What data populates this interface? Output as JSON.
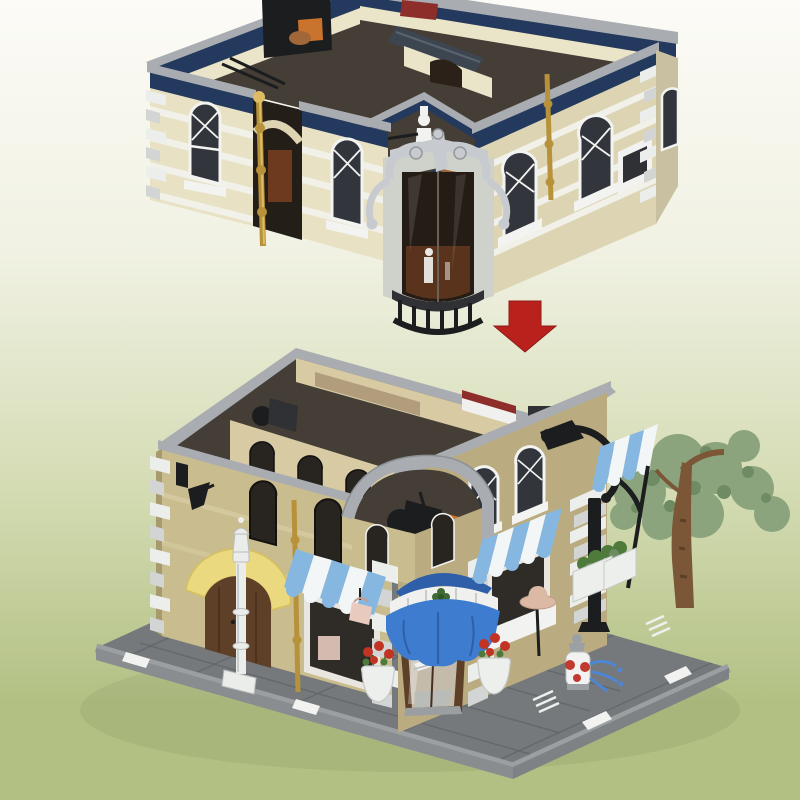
{
  "meta": {
    "image_type": "product-render",
    "subject": "Brick-built modular corner hat shop set shown as exploded view: open-top upper floor module above, red assembly arrow, completed two-story corner shop on gray street baseplate below",
    "upper_module_label": "upper floor module with navy trim, arched windows, silver scroll corner bay and black balcony",
    "arrow_label": "red downward assembly arrow",
    "lower_building_label": "assembled corner shop with blue dome awning entrance, striped awnings, street tree, lamp post and fire hydrant"
  },
  "colors": {
    "bg_top": "#fcfbf7",
    "bg_mid": "#f0f1e2",
    "bg_low": "#d3dbb2",
    "bg_bottom": "#b2c083",
    "arrow": "#b9211d",
    "coping": "#a9adb2",
    "coping_dark": "#8b9095",
    "navy": "#23395d",
    "cream": "#e8e1c3",
    "cream_dark": "#dcd4b2",
    "cream_deep": "#c8c0a0",
    "white_brick": "#f1f1e9",
    "quoin_w": "#eceeeb",
    "quoin_g": "#d2d5d3",
    "stone": "#cfd1cb",
    "stone_dark": "#a9aca5",
    "silver": "#c7cbcf",
    "silver_dark": "#94989d",
    "win_frame": "#f3f4f1",
    "win_dark": "#32363c",
    "win_dark2": "#282420",
    "glass_brown": "#251c15",
    "glass_glow": "#64371f",
    "gold": "#b7923b",
    "gold_hi": "#ddbc63",
    "black": "#1c1d1e",
    "black_soft": "#303134",
    "int_floor": "#443e36",
    "int_wall": "#eae4c9",
    "roof_slate": "#3d4550",
    "fire": "#c9732c",
    "copper": "#a26739",
    "red_item": "#8e2e2a",
    "tan": "#c9bc8f",
    "tan_dark": "#baac80",
    "tan_inner": "#d8cba4",
    "tan_deep": "#a89a6f",
    "plate": "#75797c",
    "plate_edge": "#9b9fa2",
    "plate_side": "#898d90",
    "plate_side2": "#7e8285",
    "seam": "#626569",
    "white": "#f2f3f1",
    "awn_blue": "#3e7ccf",
    "awn_blue_dk": "#2e5fa8",
    "stripe_blue": "#86b7e1",
    "stripe_white": "#f3f6f7",
    "door": "#5e3f28",
    "door_dk": "#46301d",
    "yellow": "#ead97e",
    "yellow_dk": "#d6c05e",
    "foliage": "#8ba47d",
    "foliage_dk": "#6e8b63",
    "trunk": "#7b5737",
    "trunk_dk": "#5c4026",
    "flower": "#c23324",
    "leaf": "#4e7a3c",
    "pot": "#edefec",
    "hat": "#dcb9a5",
    "bag": "#e8cabf",
    "hyd_red": "#c03a30",
    "hyd_gray": "#9aa0a4",
    "splash": "#4f86d2",
    "lamp": "#ebedeb",
    "lamp_shadow": "#c9cdcb"
  }
}
